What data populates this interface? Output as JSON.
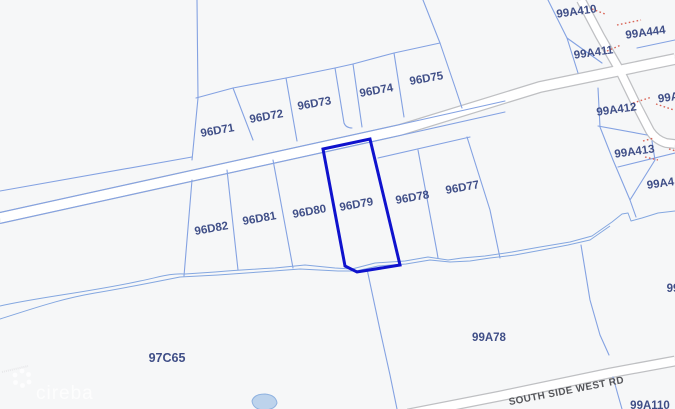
{
  "map": {
    "highlighted_parcel": "96D79",
    "colors": {
      "background": "#f6f7f8",
      "parcel_line": "#84a2e2",
      "highlight_outline": "#0f12cd",
      "parcel_label": "#3f4e87",
      "road_casing": "#bfc0c3",
      "road_fill": "#ffffff",
      "stream": "#84a7e0",
      "red_dotted": "#d96557",
      "road_label": "#55565a",
      "pond_fill": "#bdd3ec"
    },
    "parcel_labels": [
      {
        "text": "96D71",
        "x": 218,
        "y": 134,
        "rot": -10
      },
      {
        "text": "96D72",
        "x": 267,
        "y": 120,
        "rot": -10
      },
      {
        "text": "96D73",
        "x": 315,
        "y": 107,
        "rot": -10
      },
      {
        "text": "96D74",
        "x": 377,
        "y": 94,
        "rot": -10
      },
      {
        "text": "96D75",
        "x": 427,
        "y": 82,
        "rot": -10
      },
      {
        "text": "96D82",
        "x": 212,
        "y": 232,
        "rot": -10
      },
      {
        "text": "96D81",
        "x": 260,
        "y": 222,
        "rot": -10
      },
      {
        "text": "96D80",
        "x": 310,
        "y": 215,
        "rot": -10
      },
      {
        "text": "96D79",
        "x": 357,
        "y": 208,
        "rot": -10
      },
      {
        "text": "96D78",
        "x": 413,
        "y": 201,
        "rot": -10
      },
      {
        "text": "96D77",
        "x": 463,
        "y": 191,
        "rot": -10
      },
      {
        "text": "99A410",
        "x": 577,
        "y": 15,
        "rot": -8
      },
      {
        "text": "99A444",
        "x": 646,
        "y": 36,
        "rot": -8
      },
      {
        "text": "99A411",
        "x": 594,
        "y": 56,
        "rot": -8
      },
      {
        "text": "99A412",
        "x": 617,
        "y": 113,
        "rot": -8
      },
      {
        "text": "99A413",
        "x": 635,
        "y": 155,
        "rot": -8
      },
      {
        "text": "99A",
        "x": 669,
        "y": 101,
        "rot": -8
      },
      {
        "text": "99A4",
        "x": 661,
        "y": 187,
        "rot": -8
      },
      {
        "text": "99",
        "x": 673,
        "y": 292,
        "rot": 0
      },
      {
        "text": "97C65",
        "x": 167,
        "y": 362,
        "rot": 0,
        "cls": "big"
      },
      {
        "text": "99A78",
        "x": 489,
        "y": 341,
        "rot": 0
      },
      {
        "text": "99A110",
        "x": 650,
        "y": 409,
        "rot": 0
      }
    ],
    "road_label": {
      "text": "SOUTH SIDE WEST RD",
      "x": 567,
      "y": 394,
      "rot": -11
    },
    "watermark": {
      "text": "cireba",
      "logo": "flower-icon"
    }
  }
}
